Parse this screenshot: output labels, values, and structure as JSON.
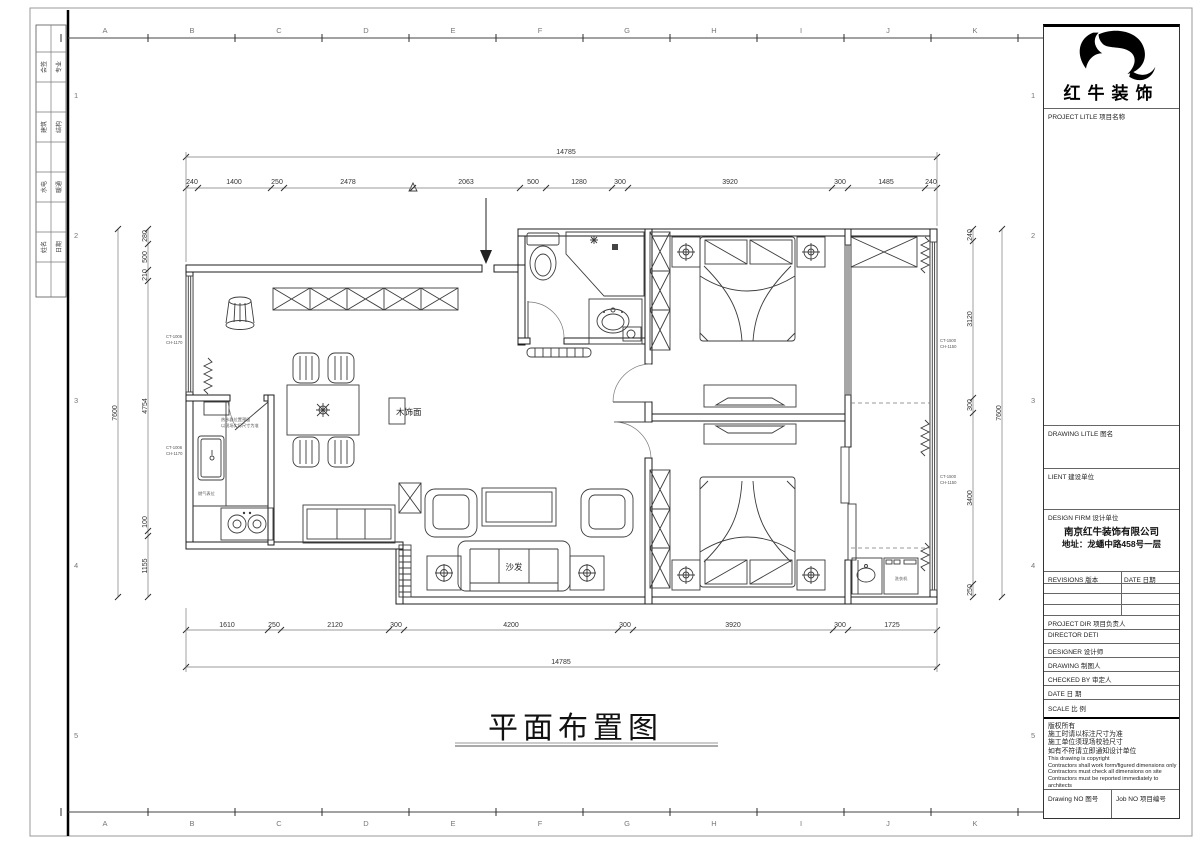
{
  "sheet": {
    "grid_letters": [
      "A",
      "B",
      "C",
      "D",
      "E",
      "F",
      "G",
      "H",
      "I",
      "J",
      "K"
    ],
    "grid_numbers": [
      "1",
      "2",
      "3",
      "4",
      "5"
    ],
    "signoff_rows": [
      [
        "会签",
        "专业"
      ],
      [
        "建筑",
        "结构"
      ],
      [
        "水电",
        "暖通"
      ],
      [
        "姓名",
        "日期"
      ]
    ]
  },
  "title_block": {
    "brand": "红牛装饰",
    "project_title_label": "PROJECT LITLE  项目名称",
    "drawing_title_label": "DRAWING LITLE  图名",
    "client_label": "LIENT  建设单位",
    "design_firm_label": "DESIGN FIRM  设计单位",
    "firm_name": "南京红牛装饰有限公司",
    "firm_address": "地址：龙蟠中路458号一层",
    "revisions_label": "REVISIONS  版本",
    "revisions_date_label": "DATE 日期",
    "project_dir_label": "PROJECT DIR    项目负责人",
    "director_label": "DIRECTOR DETI",
    "designer_label": "DESIGNER        设计师",
    "drawing_by_label": "DRAWING         制图人",
    "checked_by_label": "CHECKED BY   审定人",
    "date_label": "DATE                日  期",
    "scale_label": "SCALE              比  例",
    "notes_cn": [
      "版权所有",
      "施工时请以标注尺寸为准",
      "施工单位须现场校验尺寸",
      "如有不符请立即通知设计单位"
    ],
    "notes_en": [
      "This drawing is copyright",
      "Contractors shall work form/figured dimensions only",
      "Contractors must check all dimensions on site",
      "Contractors must be reported immediately to architects"
    ],
    "drawing_no_label": "Drawing NO  图号",
    "job_no_label": "Job NO  项目编号"
  },
  "plan": {
    "title": "平面布置图",
    "room_labels": {
      "sofa": "沙发",
      "wood_panel": "木饰面",
      "washer": "洗衣机"
    },
    "kitchen_notes": [
      "热水器位置预留",
      "以现场实际尺寸为准",
      "燃气表位"
    ],
    "window_tags": {
      "left_upper": [
        "CT-1006",
        "CH-1170"
      ],
      "left_lower": [
        "CT-1006",
        "CH-1170"
      ],
      "right_upper": [
        "CT-1500",
        "CH-1150"
      ],
      "right_lower": [
        "CT-1500",
        "CH-1150"
      ]
    },
    "dims": {
      "top_total": "14785",
      "top": [
        "240",
        "1400",
        "250",
        "2478",
        "2063",
        "500",
        "1280",
        "300",
        "3920",
        "300",
        "1485",
        "240"
      ],
      "bottom_total": "14785",
      "bottom": [
        "1610",
        "250",
        "2120",
        "300",
        "4200",
        "300",
        "3920",
        "300",
        "1725"
      ],
      "left_total": "7600",
      "left": [
        "280",
        "500",
        "210",
        "4754",
        "100",
        "1155"
      ],
      "right_total": "7600",
      "right": [
        "240",
        "3120",
        "300",
        "3400",
        "250"
      ]
    }
  }
}
